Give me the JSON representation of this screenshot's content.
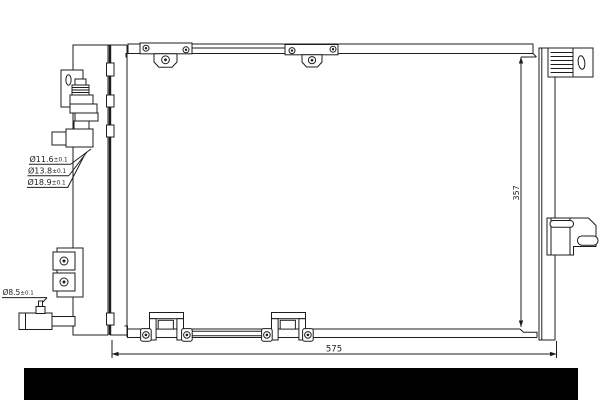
{
  "drawing": {
    "type": "technical-part-diagram",
    "part": "ac-condenser-front-view"
  },
  "dimensions": {
    "width_mm": "575",
    "height_mm": "357"
  },
  "port_labels": [
    {
      "diameter": "Ø11.6",
      "tolerance": "±0.1"
    },
    {
      "diameter": "Ø13.8",
      "tolerance": "±0.1"
    },
    {
      "diameter": "Ø18.9",
      "tolerance": "±0.1"
    }
  ],
  "valve_label": {
    "diameter": "Ø8.5",
    "tolerance": "±0.1"
  },
  "colors": {
    "line": "#1d1d1d",
    "background": "#ffffff",
    "redaction_bar": "#000000"
  }
}
